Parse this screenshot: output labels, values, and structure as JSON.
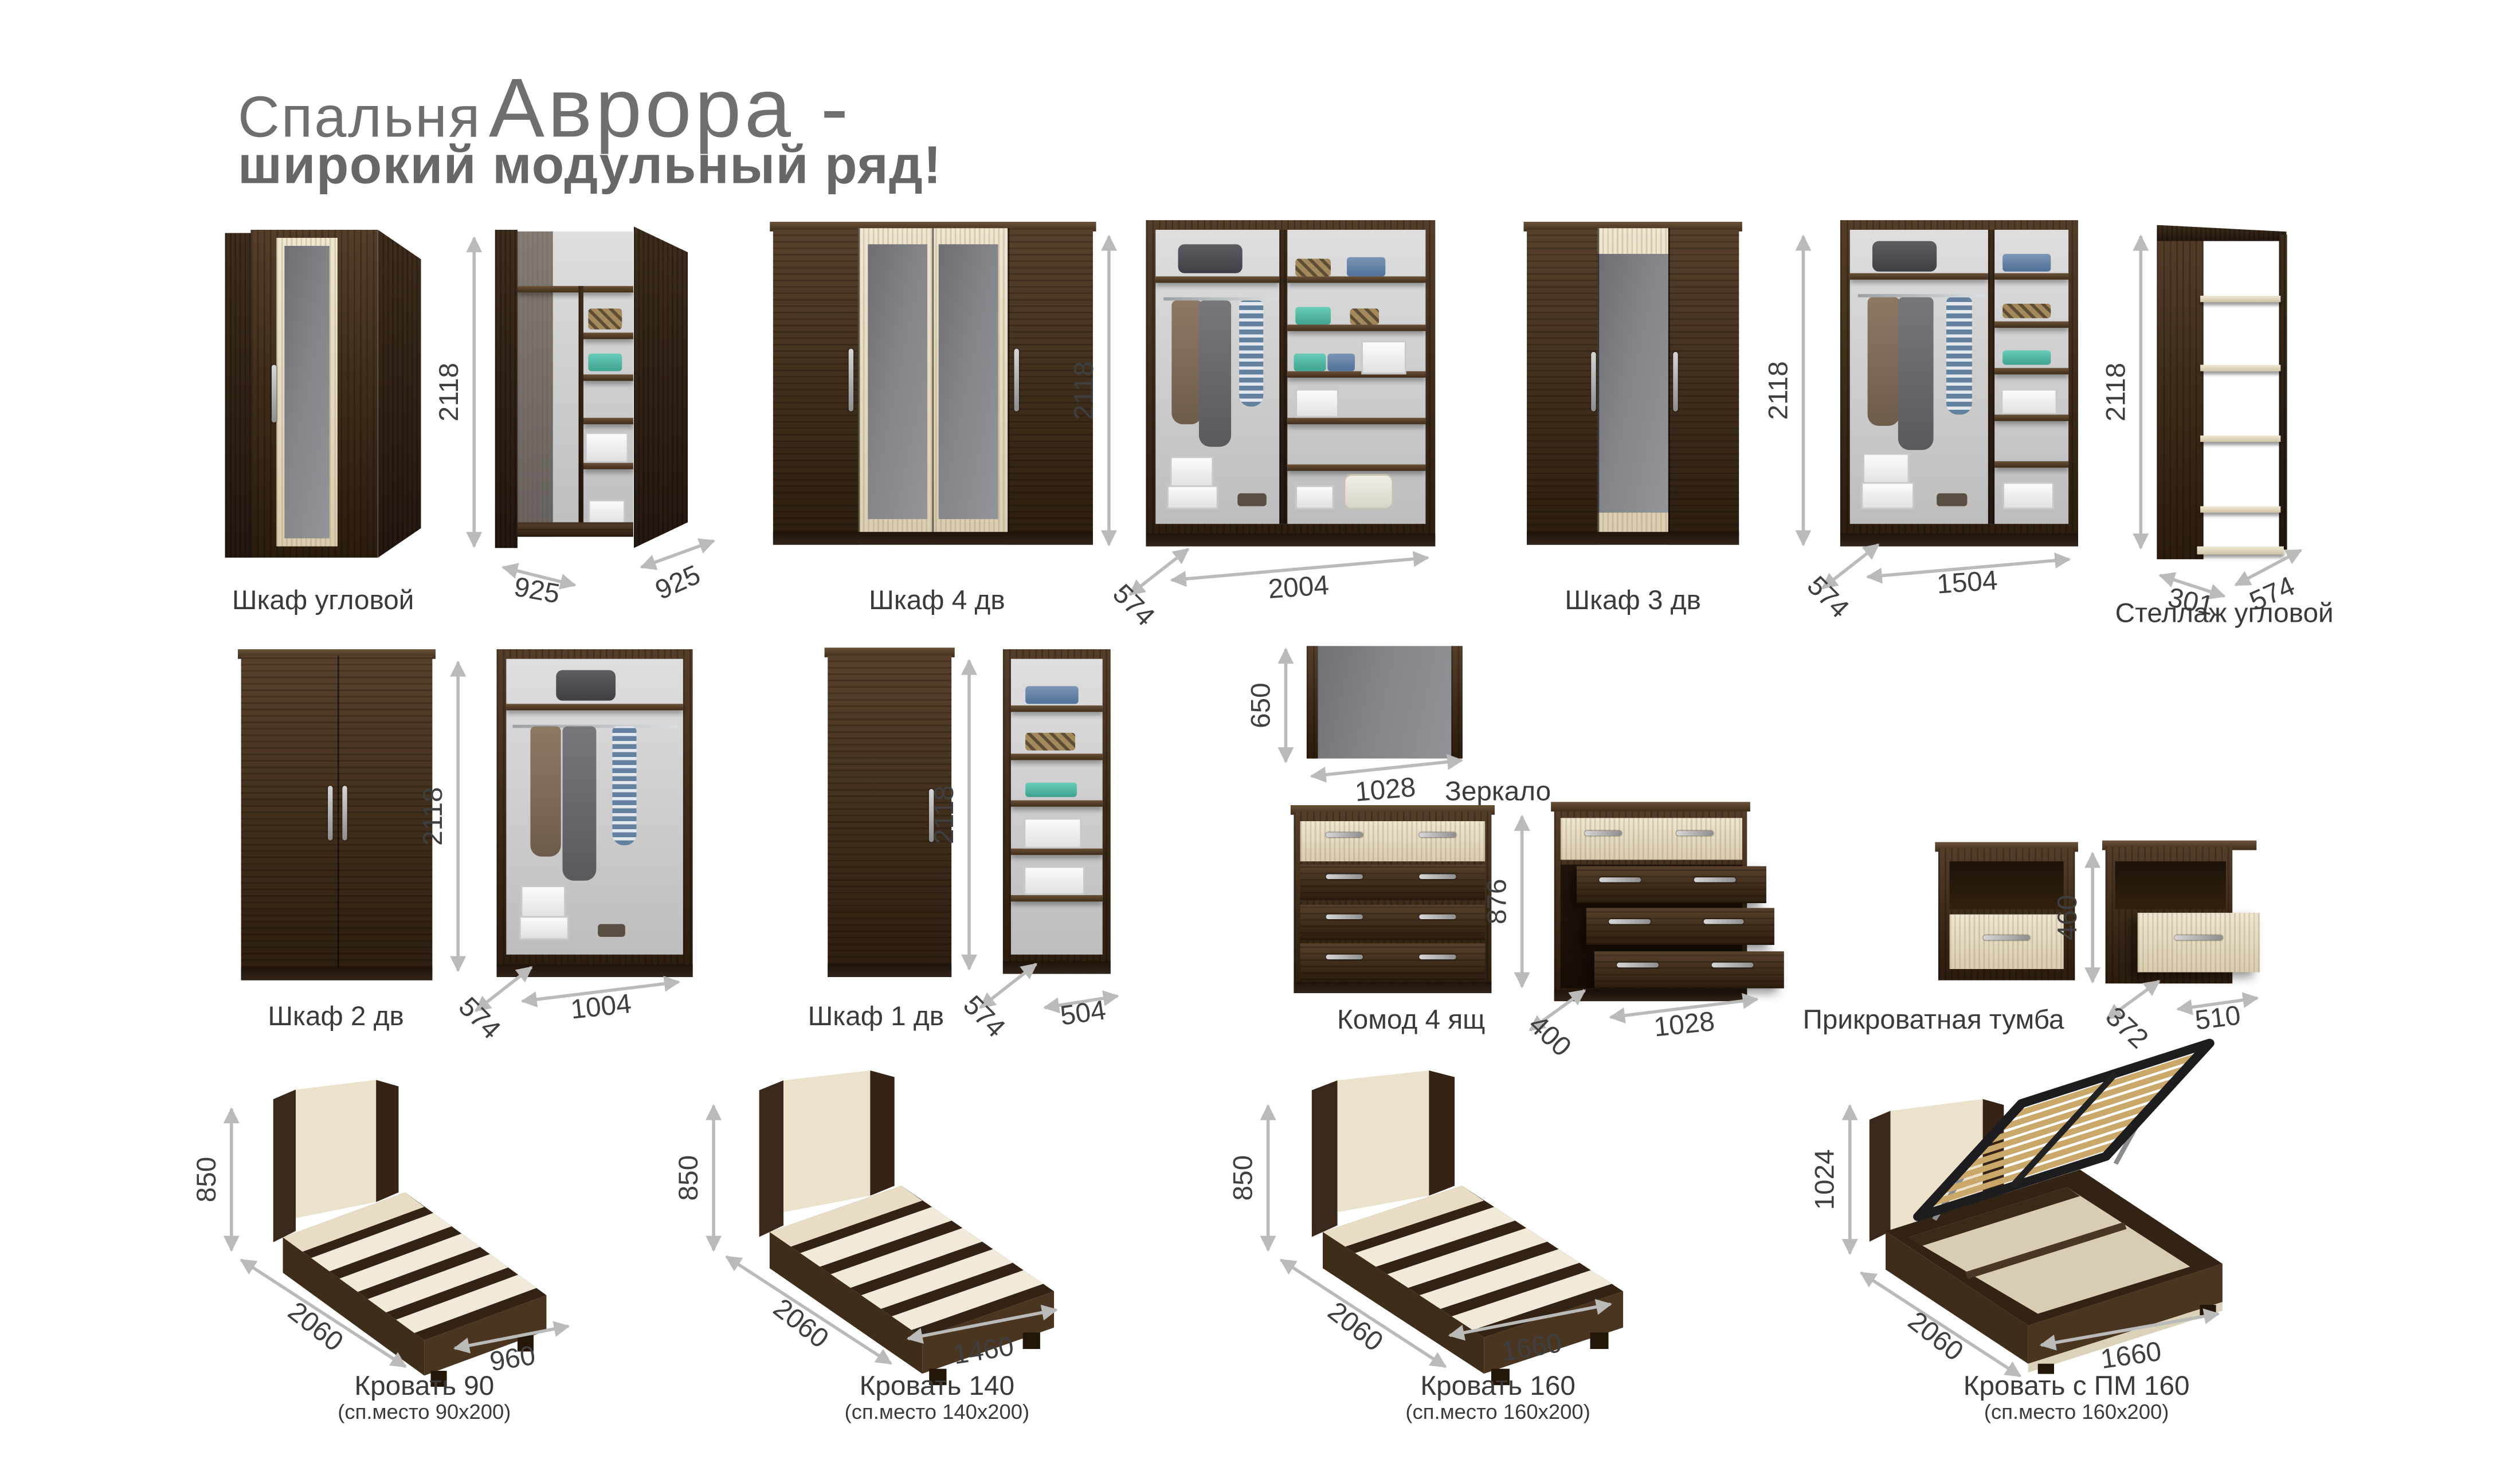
{
  "title": {
    "prefix": "Спальня",
    "brand": "Аврора -",
    "line2": "широкий модульный ряд!"
  },
  "colors": {
    "wood_dark": "#3b2a18",
    "beige": "#e9dfc8",
    "mirror_gray": "#85878a",
    "dimension_gray": "#babab9",
    "text_gray": "#3f3f3f",
    "title_gray": "#6f6f6f"
  },
  "products": [
    {
      "label": "Шкаф угловой",
      "height": "2118",
      "width_left": "925",
      "width_right": "925"
    },
    {
      "label": "Шкаф 4 дв",
      "height": "2118",
      "depth": "574",
      "width": "2004"
    },
    {
      "label": "Шкаф 3 дв",
      "height": "2118",
      "depth": "574",
      "width": "1504"
    },
    {
      "label": "Стеллаж угловой",
      "height": "2118",
      "width_left": "301",
      "depth": "574"
    },
    {
      "label": "Шкаф 2 дв",
      "height": "2118",
      "depth": "574",
      "width": "1004"
    },
    {
      "label": "Шкаф 1 дв",
      "height": "2118",
      "depth": "574",
      "width": "504"
    },
    {
      "label": "Зеркало",
      "height": "650",
      "width": "1028"
    },
    {
      "label": "Комод 4 ящ",
      "height": "876",
      "depth": "400",
      "width": "1028"
    },
    {
      "label": "Прикроватная тумба",
      "height": "460",
      "depth": "372",
      "width": "510"
    },
    {
      "label": "Кровать 90",
      "sublabel": "(сп.место 90x200)",
      "height": "850",
      "length": "2060",
      "width": "960"
    },
    {
      "label": "Кровать 140",
      "sublabel": "(сп.место 140x200)",
      "height": "850",
      "length": "2060",
      "width": "1460"
    },
    {
      "label": "Кровать 160",
      "sublabel": "(сп.место 160x200)",
      "height": "850",
      "length": "2060",
      "width": "1660"
    },
    {
      "label": "Кровать с ПМ 160",
      "sublabel": "(сп.место 160x200)",
      "height": "1024",
      "length": "2060",
      "width": "1660"
    }
  ]
}
